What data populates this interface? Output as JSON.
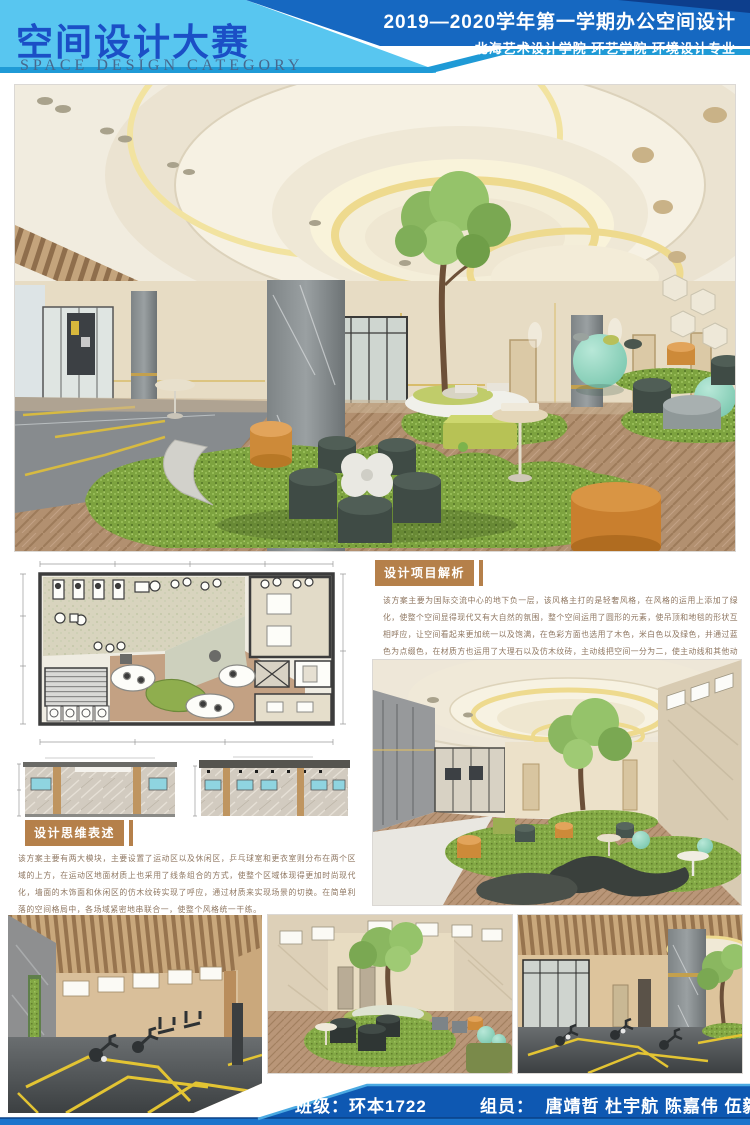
{
  "header": {
    "title_cn": "空间设计大赛",
    "title_en": "SPACE DESIGN CATEGORY",
    "term_line": "2019—2020学年第一学期办公空间设计",
    "school_line": "北海艺术设计学院 环艺学院 环境设计专业"
  },
  "sections": {
    "analysis": {
      "title": "设计项目解析",
      "body": "该方案主要为国际交流中心的地下负一层，该风格主打的是轻奢风格，在风格的运用上添加了绿化，使整个空间显得现代又有大自然的氛围，整个空间运用了圆形的元素，使吊顶和地毯的形状互相呼应，让空间看起来更加统一以及饱满，在色彩方面也选用了木色，米白色以及绿色，并通过蓝色为点缀色，在材质方也运用了大理石以及仿木纹砖，主动线把空间一分为二，使主动线和其他动线互不冲突和干扰。"
    },
    "thinking": {
      "title": "设计思维表述",
      "body": "该方案主要有两大模块，主要设置了运动区以及休闲区，乒乓球室和更衣室则分布在两个区域的上方，在运动区地面材质上也采用了线条组合的方式，使整个区域体现得更加时尚现代化，墙面的木饰面和休闲区的仿木纹砖实现了呼应，通过材质来实现场景的切换。在简单利落的空间格局中，各场域紧密地串联合一，使整个风格统一干练。"
    }
  },
  "footer": {
    "class_label": "班级：环本1722",
    "members_label": "组员：  唐靖哲 杜宇航 陈嘉伟 伍毅"
  },
  "colors": {
    "header_light_blue": "#58C6F0",
    "header_dark_blue": "#1668C1",
    "header_stripe_blue": "#1F9AD6",
    "title_blue": "#1B4FC6",
    "section_tan": "#B5804A",
    "body_text_brown": "#8E7660",
    "footer_blue": "#0E58B2",
    "footer_stripe_blue": "#1B74CC",
    "carpet_green": "#7DA33F",
    "wood_floor": "#B29070",
    "ottoman_orange": "#CD8A39",
    "ottoman_dark": "#3F4B45",
    "mint_ball": "#8FD6BE"
  }
}
